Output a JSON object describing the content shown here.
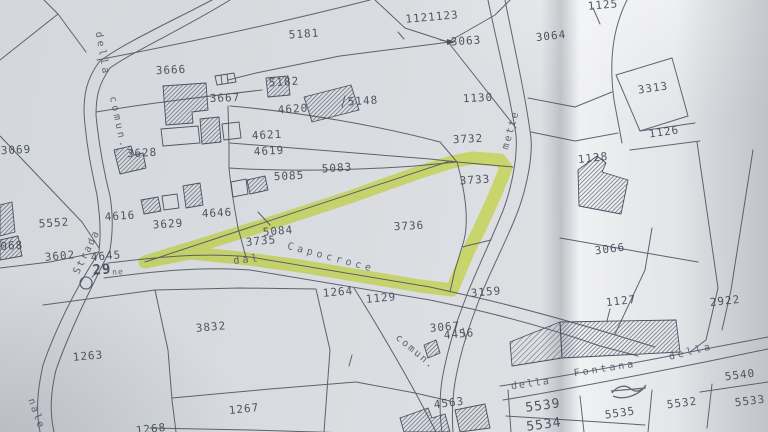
{
  "map": {
    "type": "cadastral-parcel-map-photo",
    "colors": {
      "paper": "#d9dce0",
      "ink": "#4b5160",
      "highlight": "#dff046"
    },
    "highlight": {
      "color": "#dff046",
      "traced_parcel": "3736"
    },
    "parcel_labels": [
      {
        "text": "1121123",
        "x": 432,
        "y": 17,
        "rot": -5
      },
      {
        "text": "3063",
        "x": 466,
        "y": 41,
        "rot": -4
      },
      {
        "text": "3064",
        "x": 551,
        "y": 36,
        "rot": -6
      },
      {
        "text": "1125",
        "x": 603,
        "y": 5,
        "rot": -5
      },
      {
        "text": "5181",
        "x": 304,
        "y": 34,
        "rot": -4
      },
      {
        "text": "3666",
        "x": 171,
        "y": 70,
        "rot": -3
      },
      {
        "text": "3667",
        "x": 225,
        "y": 98,
        "rot": -2
      },
      {
        "text": "5182",
        "x": 284,
        "y": 82,
        "rot": -4
      },
      {
        "text": "4620",
        "x": 293,
        "y": 109,
        "rot": -4
      },
      {
        "text": "5148",
        "x": 363,
        "y": 101,
        "rot": -4
      },
      {
        "text": "1130",
        "x": 478,
        "y": 98,
        "rot": -3
      },
      {
        "text": "3313",
        "x": 653,
        "y": 88,
        "rot": -8
      },
      {
        "text": "1126",
        "x": 664,
        "y": 132,
        "rot": -8
      },
      {
        "text": "4621",
        "x": 267,
        "y": 135,
        "rot": -3
      },
      {
        "text": "4619",
        "x": 269,
        "y": 151,
        "rot": -3
      },
      {
        "text": "3628",
        "x": 142,
        "y": 153,
        "rot": -3
      },
      {
        "text": "3069",
        "x": 16,
        "y": 150,
        "rot": -3
      },
      {
        "text": "5083",
        "x": 337,
        "y": 168,
        "rot": -4
      },
      {
        "text": "5085",
        "x": 289,
        "y": 176,
        "rot": -3
      },
      {
        "text": "3732",
        "x": 468,
        "y": 139,
        "rot": -3
      },
      {
        "text": "3733",
        "x": 475,
        "y": 180,
        "rot": -4
      },
      {
        "text": "1128",
        "x": 593,
        "y": 158,
        "rot": -6
      },
      {
        "text": "4616",
        "x": 120,
        "y": 216,
        "rot": -4
      },
      {
        "text": "3629",
        "x": 168,
        "y": 224,
        "rot": -4
      },
      {
        "text": "4646",
        "x": 217,
        "y": 213,
        "rot": -3
      },
      {
        "text": "5552",
        "x": 54,
        "y": 223,
        "rot": -4
      },
      {
        "text": "5084",
        "x": 278,
        "y": 231,
        "rot": -5
      },
      {
        "text": "3735",
        "x": 261,
        "y": 241,
        "rot": -5
      },
      {
        "text": "3736",
        "x": 409,
        "y": 226,
        "rot": -3
      },
      {
        "text": "3602",
        "x": 60,
        "y": 256,
        "rot": -5
      },
      {
        "text": "4645",
        "x": 106,
        "y": 256,
        "rot": -5
      },
      {
        "text": "29",
        "x": 102,
        "y": 270,
        "rot": -5,
        "size": 14,
        "bold": true
      },
      {
        "text": "3066",
        "x": 610,
        "y": 249,
        "rot": -7
      },
      {
        "text": "1264",
        "x": 338,
        "y": 292,
        "rot": -5
      },
      {
        "text": "1129",
        "x": 381,
        "y": 298,
        "rot": -5
      },
      {
        "text": "3159",
        "x": 486,
        "y": 292,
        "rot": -5
      },
      {
        "text": "3067",
        "x": 445,
        "y": 327,
        "rot": -5
      },
      {
        "text": "4456",
        "x": 459,
        "y": 334,
        "rot": -5
      },
      {
        "text": "1127",
        "x": 621,
        "y": 301,
        "rot": -6
      },
      {
        "text": "2922",
        "x": 725,
        "y": 301,
        "rot": -6
      },
      {
        "text": "3832",
        "x": 211,
        "y": 327,
        "rot": -5
      },
      {
        "text": "1263",
        "x": 88,
        "y": 356,
        "rot": -5
      },
      {
        "text": "1267",
        "x": 244,
        "y": 409,
        "rot": -6
      },
      {
        "text": "1268",
        "x": 151,
        "y": 429,
        "rot": -6
      },
      {
        "text": "4563",
        "x": 449,
        "y": 403,
        "rot": -7
      },
      {
        "text": "5540",
        "x": 740,
        "y": 375,
        "rot": -7
      },
      {
        "text": "5539",
        "x": 543,
        "y": 406,
        "rot": -8,
        "size": 13
      },
      {
        "text": "5532",
        "x": 682,
        "y": 403,
        "rot": -7
      },
      {
        "text": "5533",
        "x": 750,
        "y": 401,
        "rot": -7
      },
      {
        "text": "5535",
        "x": 620,
        "y": 413,
        "rot": -8
      },
      {
        "text": "5534",
        "x": 544,
        "y": 425,
        "rot": -8,
        "size": 13
      },
      {
        "text": "3068",
        "x": 8,
        "y": 246,
        "rot": -4
      }
    ],
    "road_labels": [
      {
        "text": "della",
        "x": 102,
        "y": 54,
        "rot": 80,
        "ls": 3
      },
      {
        "text": "comun.",
        "x": 118,
        "y": 123,
        "rot": 78,
        "ls": 3
      },
      {
        "text": "Strada",
        "x": 87,
        "y": 252,
        "rot": -64,
        "ls": 2
      },
      {
        "text": "nale",
        "x": 36,
        "y": 414,
        "rot": 70,
        "ls": 2
      },
      {
        "text": "dal",
        "x": 247,
        "y": 260,
        "rot": -6,
        "ls": 3
      },
      {
        "text": "Capocroce",
        "x": 331,
        "y": 258,
        "rot": 15,
        "ls": 4
      },
      {
        "text": "mette",
        "x": 511,
        "y": 130,
        "rot": -74,
        "ls": 2
      },
      {
        "text": "comun.",
        "x": 415,
        "y": 352,
        "rot": 40,
        "ls": 2
      },
      {
        "text": "della",
        "x": 691,
        "y": 352,
        "rot": -14,
        "ls": 3
      },
      {
        "text": "Fontana",
        "x": 605,
        "y": 369,
        "rot": -9,
        "ls": 3
      },
      {
        "text": "della",
        "x": 531,
        "y": 384,
        "rot": -8,
        "ls": 2
      },
      {
        "text": "ne",
        "x": 118,
        "y": 272,
        "rot": -5,
        "ls": 1,
        "size": 8
      }
    ],
    "symbols": [
      {
        "name": "well-circle",
        "x": 86,
        "y": 283
      },
      {
        "name": "scribbled-number",
        "x": 627,
        "y": 391
      }
    ]
  }
}
